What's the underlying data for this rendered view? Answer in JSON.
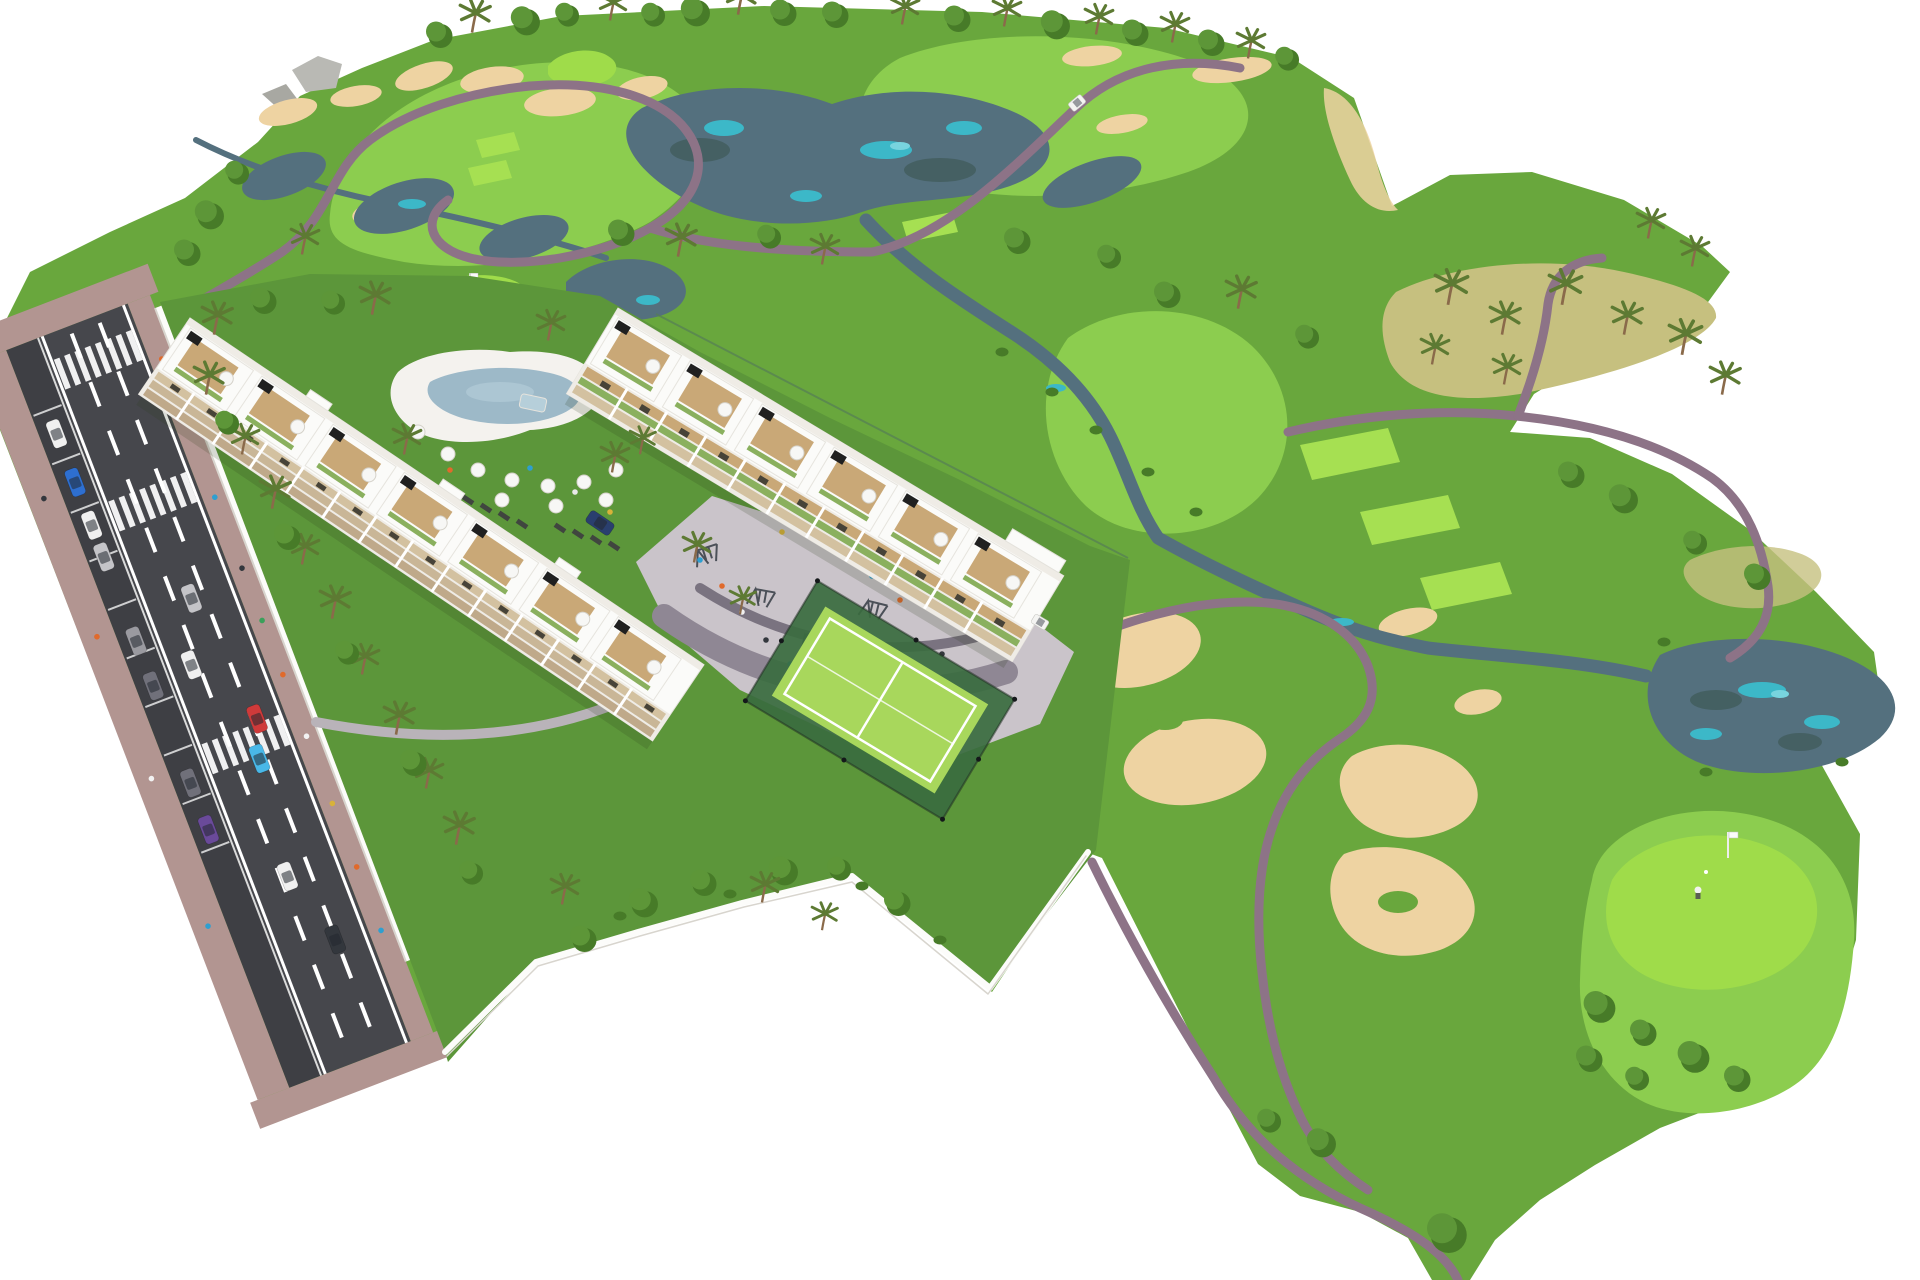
{
  "image": {
    "kind": "architectural-aerial-render",
    "subject": "golf resort residential development with two apartment blocks, street, pool, playground, padel court and surrounding golf course",
    "background": "#ffffff"
  },
  "palette": {
    "bg": "#ffffff",
    "rough": "#69a73d",
    "rough_dark": "#588f31",
    "garden": "#5c963a",
    "fairway": "#8ccd4f",
    "green_bright": "#9fdc4a",
    "tee": "#a6e052",
    "lake": "#54707e",
    "lake_teal": "#3cb8c8",
    "lake_teal_light": "#78d4de",
    "sand": "#eed3a2",
    "arid": "#c6c07f",
    "path": "#8d7387",
    "rock": "#b9b9b4",
    "rock_dark": "#a8a8a2",
    "sidewalk": "#b29591",
    "asphalt": "#46474c",
    "parking": "#3e3f44",
    "road_white": "#ffffff",
    "wall": "#fcfcfa",
    "wall_shadow": "#d8d5ce",
    "bld_white": "#fbfbf9",
    "bld_shade": "#efece6",
    "bld_edge": "#e4e2dc",
    "bld_band": "#d3c1a0",
    "bld_band2": "#c9b697",
    "bld_band3": "#bfa98a",
    "bld_glass": "#474338",
    "wood": "#c9a877",
    "hedge": "#8ab05e",
    "canopy": "#5d9638",
    "canopy_dark": "#477b28",
    "palm": "#5d7a33",
    "trunk": "#8a6a4a",
    "plaza": "#cac4ca",
    "plaza_band": "#8f8794",
    "plaza_band_dark": "#7a7380",
    "court_dark": "#3a6b3f",
    "court_light": "#a8d75c",
    "court_line": "#ffffff",
    "pool_deck": "#f4f2ee",
    "pool_water": "#9db9c8",
    "pool_water_light": "#b6cfda",
    "umbrella_white": "#f7f7f5",
    "umbrella_stroke": "#d5d2ca",
    "cart_white": "#f4f4f2",
    "flag_pole": "#ededed",
    "lounger": "#40453f",
    "person_blue": "#2e9fd0",
    "person_orange": "#e06a2c",
    "person_dark": "#33373d",
    "person_green": "#3aa05a",
    "person_yellow": "#d8b23a",
    "car_white": "#f0f0f0",
    "car_blue": "#2e6fd0",
    "car_lightblue": "#49b8e8",
    "car_red": "#cf3a3a",
    "car_silver": "#c4c4c8",
    "car_gray": "#9a9aa0",
    "car_darkgray": "#70707a",
    "car_darkblue": "#2a3f6e",
    "car_purple": "#6a4a9a",
    "gym_metal": "#4b5058"
  },
  "scene": {
    "areas": [
      {
        "name": "golf-course",
        "features": [
          "fairways",
          "putting-greens",
          "tee-boxes",
          "sand-bunkers",
          "lakes",
          "winding-river",
          "cart-paths",
          "round-trees",
          "palm-trees",
          "rocks",
          "arid-grass-patches"
        ]
      },
      {
        "name": "street",
        "features": [
          "two-lane-road",
          "dashed-lane-markings",
          "zebra-crossings",
          "parking-lane",
          "parked-cars",
          "moving-cars",
          "brick-sidewalks",
          "pedestrians"
        ]
      },
      {
        "name": "residential-complex",
        "features": [
          "apartment-building-a",
          "apartment-building-b",
          "rooftop-terraces",
          "roof-umbrellas",
          "balcony-wood-bands",
          "swimming-pool",
          "pool-umbrellas",
          "sun-loungers",
          "playground-plaza",
          "outdoor-gym",
          "padel-court",
          "gardens",
          "perimeter-wall",
          "putting-green"
        ]
      }
    ],
    "figures": {
      "golfer_on_green": 1,
      "golfer_putting": 1,
      "golf_carts": 2,
      "flags": 2
    }
  }
}
